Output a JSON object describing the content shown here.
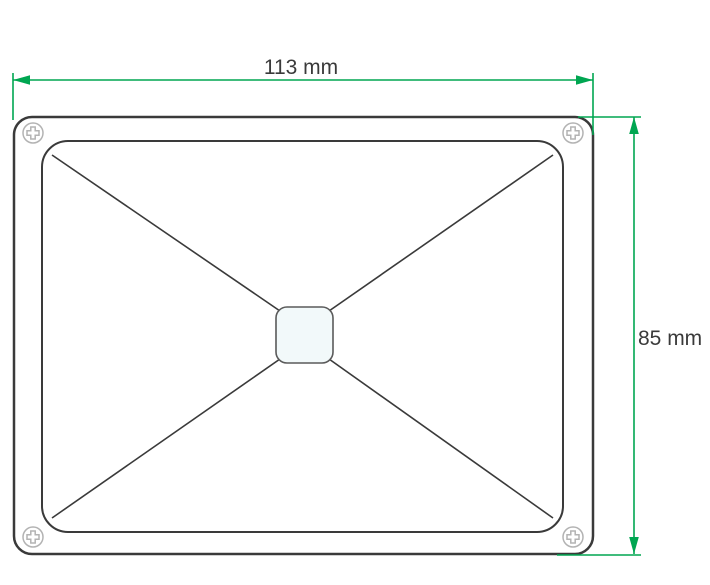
{
  "labels": {
    "width": "113 mm",
    "height": "85 mm"
  },
  "colors": {
    "dimension_green": "#00a651",
    "line_dark": "#3a3a3a",
    "screw_gray": "#b3b3b3",
    "center_fill": "#f2f9fa",
    "background": "#ffffff"
  },
  "icons": {
    "screw_top_left": "phillips-screw-icon",
    "screw_top_right": "phillips-screw-icon",
    "screw_bottom_left": "phillips-screw-icon",
    "screw_bottom_right": "phillips-screw-icon"
  }
}
